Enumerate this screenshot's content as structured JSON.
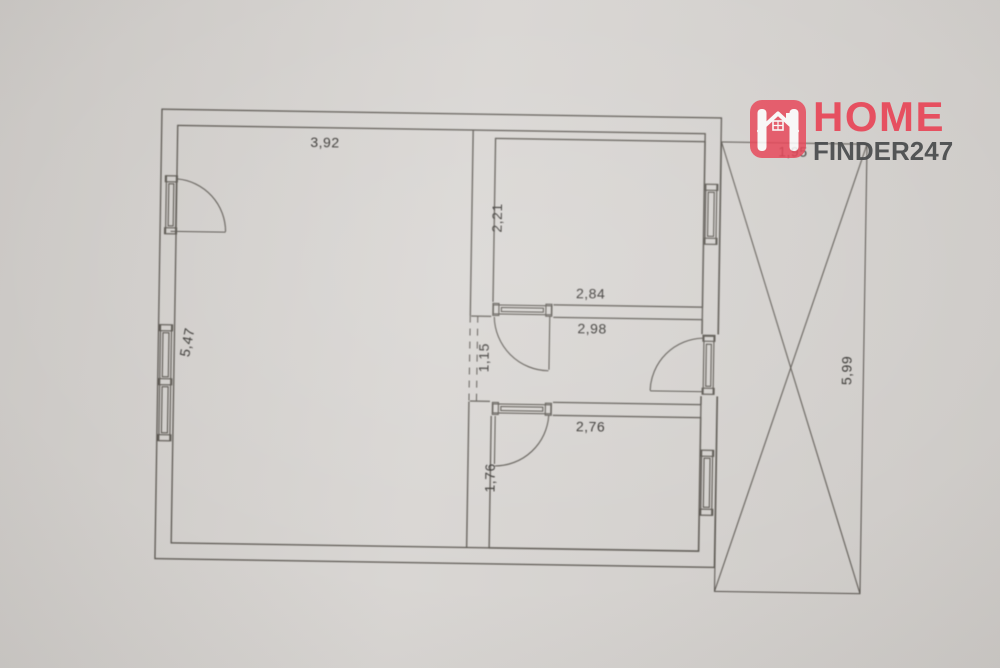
{
  "watermark": {
    "brand_top": "HOME",
    "brand_bottom": "FINDER247",
    "brand_color": "#e84a5b",
    "brand_secondary_color": "#4a4c4e",
    "icon": "house-in-rounded-square-icon"
  },
  "floorplan": {
    "paper_color": "#d7d4d1",
    "line_color": "#55514b",
    "decimal_separator": ",",
    "dims": {
      "living_w": "3,92",
      "living_h": "5,47",
      "top_w": "2,84",
      "top_h": "2,21",
      "hall_w": "2,98",
      "hall_h": "1,15",
      "bottom_w": "2,76",
      "bottom_h": "1,76",
      "terrace_w": "1,95",
      "terrace_h": "5,99"
    },
    "elements": [
      "entry-door-icon",
      "window-icon-left-wall",
      "window-icon-top-right-wall",
      "window-icon-bottom-right-wall",
      "door-icon-hall-to-top-room",
      "door-icon-hall-to-bottom-room",
      "door-icon-hall-to-terrace",
      "dashed-open-passage",
      "terrace-cross"
    ]
  }
}
